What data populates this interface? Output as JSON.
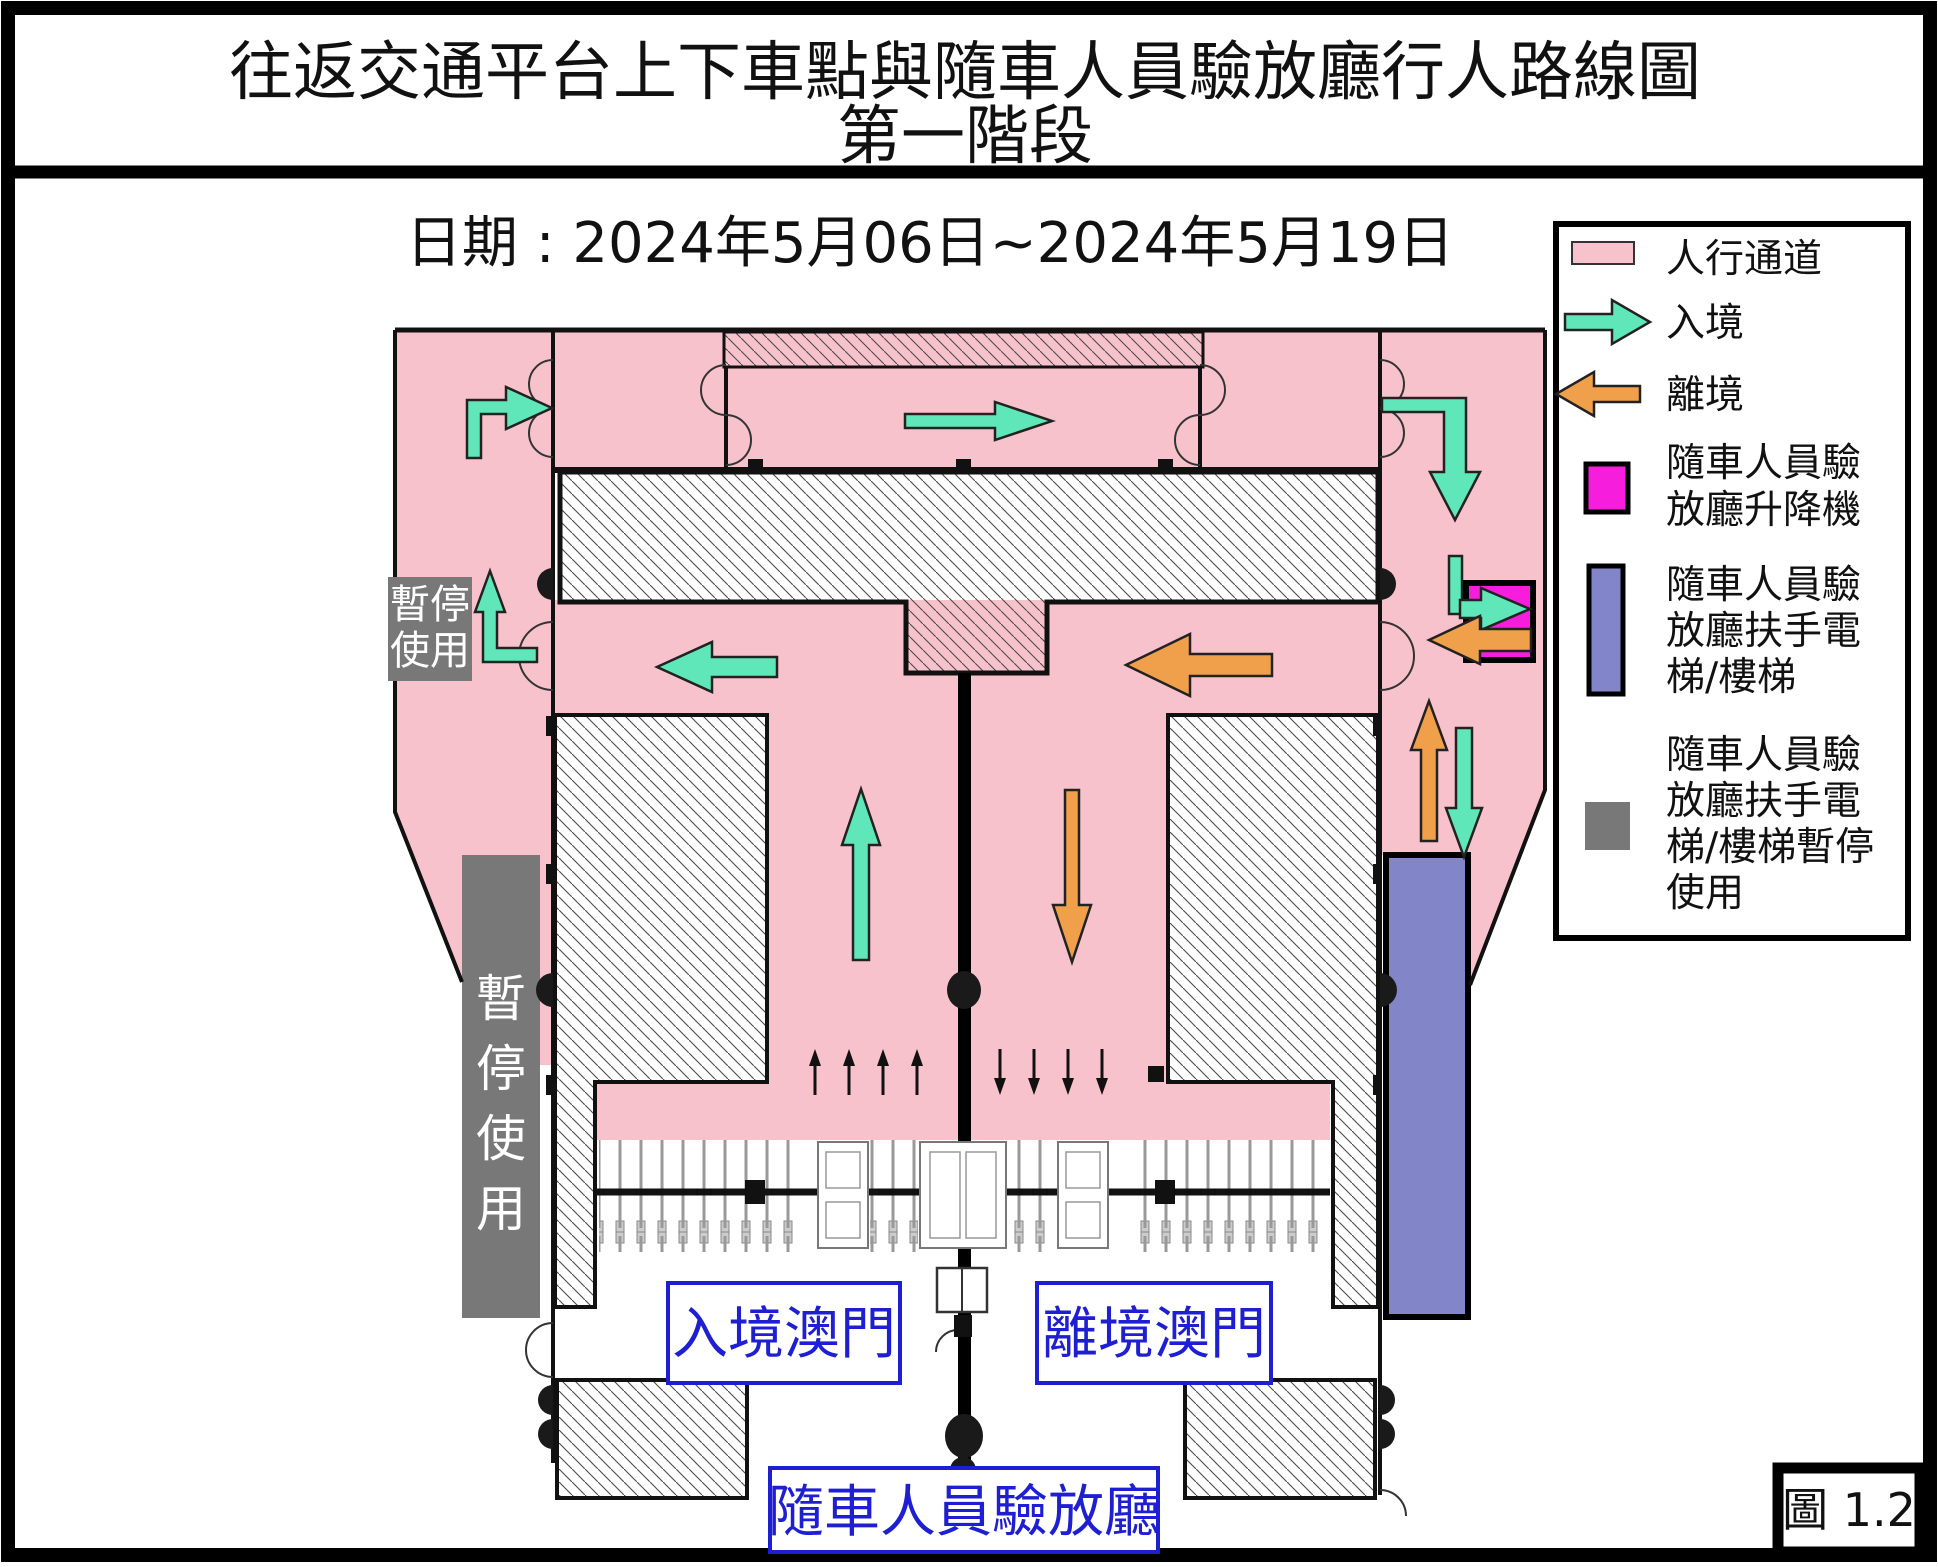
{
  "title": {
    "line1": "往返交通平台上下車點與隨車人員驗放廳行人路線圖",
    "line2": "第一階段"
  },
  "date_label": "日期 : 2024年5月06日~2024年5月19日",
  "legend": {
    "pedestrian": {
      "label": "人行通道",
      "color": "#f8c2cc"
    },
    "arrival": {
      "label": "入境",
      "color": "#5fe7ba"
    },
    "departure": {
      "label": "離境",
      "color": "#f0a04b"
    },
    "lift": {
      "label_line1": "隨車人員驗",
      "label_line2": "放廳升降機",
      "color": "#f61edc"
    },
    "escalator": {
      "label_line1": "隨車人員驗",
      "label_line2": "放廳扶手電",
      "label_line3": "梯/樓梯",
      "color": "#8285c8"
    },
    "escalator_suspended": {
      "label_line1": "隨車人員驗",
      "label_line2": "放廳扶手電",
      "label_line3": "梯/樓梯暫停",
      "label_line4": "使用",
      "color": "#787878"
    }
  },
  "plan": {
    "suspended_small": {
      "line1": "暫停",
      "line2": "使用"
    },
    "suspended_bar": {
      "char1": "暫",
      "char2": "停",
      "char3": "使",
      "char4": "用"
    },
    "arrival_macau_label": "入境澳門",
    "departure_macau_label": "離境澳門",
    "inspection_hall_label": "隨車人員驗放廳"
  },
  "figure_label": "圖 1.2",
  "colors": {
    "pedestrian_pink": "#f8c2cc",
    "arrival_teal": "#5fe7ba",
    "departure_orange": "#f0a04b",
    "lift_magenta": "#f61edc",
    "escalator_purple": "#8285c8",
    "suspended_gray": "#787878",
    "label_blue": "#1e1ed2",
    "wall_black": "#111111"
  }
}
